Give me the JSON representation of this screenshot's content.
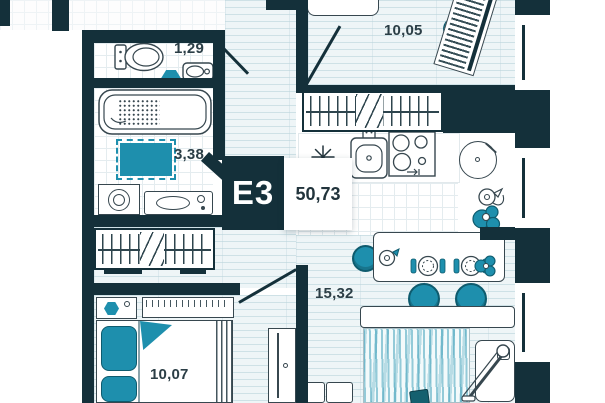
{
  "plan": {
    "unit_label": "E3",
    "total_area": "50,73",
    "areas": {
      "wc": "1,29",
      "bathroom": "3,38",
      "room_top": "10,05",
      "kitchen_living": "15,32",
      "bedroom": "10,07"
    },
    "colors": {
      "wall": "#14303a",
      "accent": "#1e8fad",
      "floor_tint": "#eef5f7",
      "tile_line": "#e4ecef"
    },
    "fixtures": [
      "toilet",
      "wc-sink",
      "wc-mat",
      "bathtub",
      "bath-mat",
      "washing-machine",
      "vanity-sink",
      "hall-wardrobe",
      "top-wardrobe",
      "fridge-snowflake",
      "kitchen-sink",
      "stove",
      "round-table",
      "kettle",
      "plant",
      "dining-table",
      "jug",
      "place-setting",
      "stools",
      "sofa",
      "rug",
      "armchair",
      "floor-lamp",
      "coffee-table",
      "tv-stand",
      "bed",
      "pillows",
      "nightstand",
      "shelf",
      "cabinet",
      "piano",
      "desk",
      "windows",
      "doors"
    ]
  }
}
